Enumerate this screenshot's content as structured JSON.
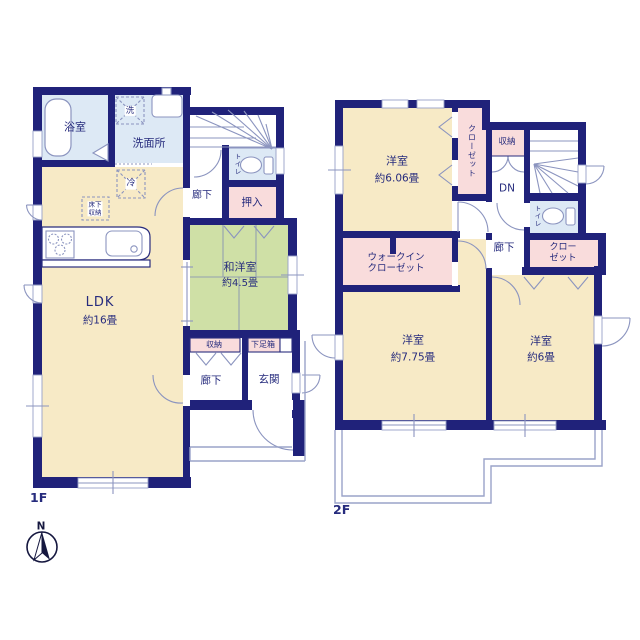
{
  "title": "2-story house floor plan",
  "compass": {
    "north_label": "N"
  },
  "colors": {
    "wall": "#20227a",
    "room_cream": "#f7eac6",
    "room_green": "#cfe0a6",
    "room_pink": "#f9dcdc",
    "room_blue": "#dde9f5",
    "linework": "#8b94bf",
    "text": "#262b7d"
  },
  "floor1": {
    "floor_label": "1F",
    "rooms": {
      "bath": "浴室",
      "laundry": "洗",
      "washroom": "洗面所",
      "fridge": "冷",
      "underfloor_line1": "床下",
      "underfloor_line2": "収納",
      "ldk_name": "LDK",
      "ldk_size": "約16畳",
      "hall_upper": "廊下",
      "toilet": "トイレ",
      "oshiire": "押入",
      "washitsu_name": "和洋室",
      "washitsu_size": "約4.5畳",
      "storage": "収納",
      "shoebox": "下足箱",
      "hall_lower": "廊下",
      "entrance": "玄関"
    }
  },
  "floor2": {
    "floor_label": "2F",
    "rooms": {
      "bed1_name": "洋室",
      "bed1_size": "約6.06畳",
      "closet1": "クローゼット",
      "storage": "収納",
      "stairs_down": "DN",
      "toilet": "トイレ",
      "hall": "廊下",
      "closet2_line1": "クロー",
      "closet2_line2": "ゼット",
      "wic_line1": "ウォークイン",
      "wic_line2": "クローゼット",
      "bed2_name": "洋室",
      "bed2_size": "約7.75畳",
      "bed3_name": "洋室",
      "bed3_size": "約6畳"
    }
  }
}
